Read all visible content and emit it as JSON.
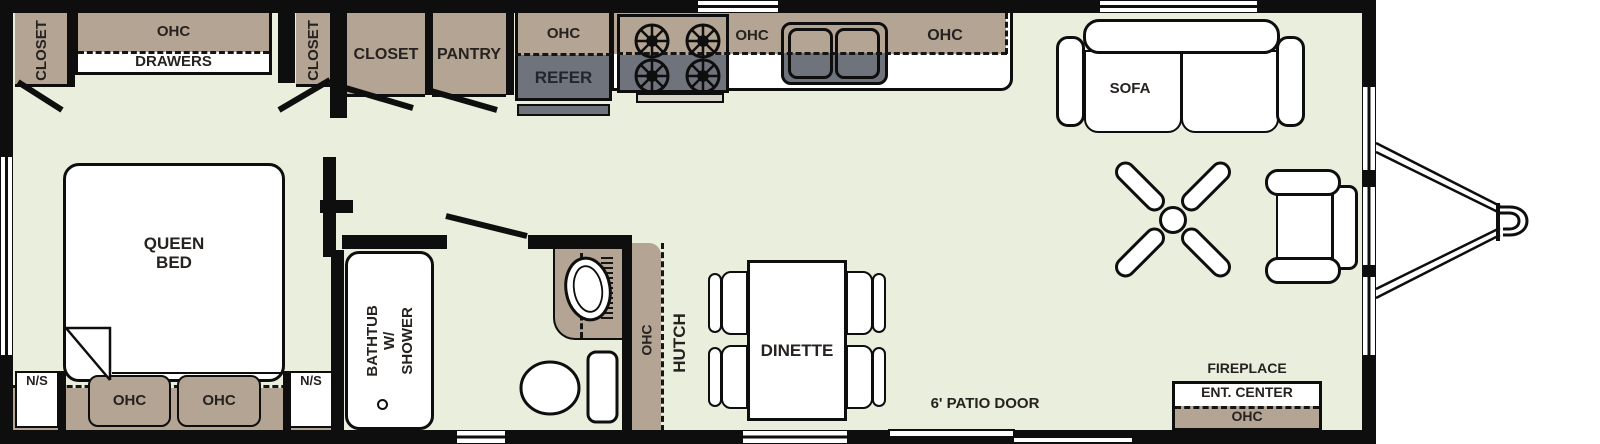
{
  "labels": {
    "closet_a": "CLOSET",
    "ohc_a": "OHC",
    "drawers": "DRAWERS",
    "closet_b": "CLOSET",
    "closet_c": "CLOSET",
    "pantry": "PANTRY",
    "fridge_ohc": "OHC",
    "refer": "REFER",
    "kitchen_ohc_left": "OHC",
    "kitchen_ohc_right": "OHC",
    "sofa": "SOFA",
    "queen_bed": "QUEEN BED",
    "ns_left": "N/S",
    "ns_right": "N/S",
    "bed_ohc_left": "OHC",
    "bed_ohc_right": "OHC",
    "bathtub": "BATHTUB W/ SHOWER",
    "med": "MED",
    "hutch_ohc": "OHC",
    "hutch": "HUTCH",
    "dinette": "DINETTE",
    "patio_door": "6' PATIO DOOR",
    "fireplace": "FIREPLACE",
    "ent_center": "ENT. CENTER",
    "ent_ohc": "OHC"
  },
  "colors": {
    "floor": "#e9efdc",
    "cabinet_tan": "#b3a493",
    "appliance_gray": "#6e737c",
    "wall_black": "#0e0e0e",
    "furniture_white": "#ffffff"
  }
}
